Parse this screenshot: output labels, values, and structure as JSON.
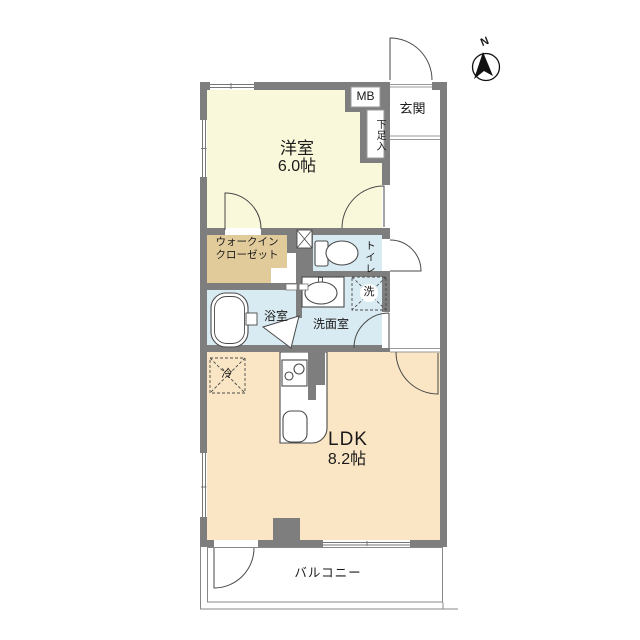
{
  "compass": {
    "north_label": "N"
  },
  "rooms": {
    "bedroom": {
      "name": "洋室",
      "size": "6.0帖"
    },
    "ldk": {
      "name": "LDK",
      "size": "8.2帖"
    },
    "entrance": {
      "name": "玄関"
    },
    "meter_box": {
      "name": "MB"
    },
    "shoe_cabinet": {
      "name": "下足入"
    },
    "walk_in_closet": {
      "line1": "ウォークイン",
      "line2": "クローゼット"
    },
    "toilet": {
      "name": "トイレ"
    },
    "washroom": {
      "name": "洗面室"
    },
    "bathroom": {
      "name": "浴室"
    },
    "washer_space": {
      "name": "洗"
    },
    "refrigerator_space": {
      "name": "冷"
    },
    "balcony": {
      "name": "バルコニー"
    }
  },
  "colors": {
    "wall": "#7e7e7e",
    "bedroom_fill": "#faf8da",
    "ldk_fill": "#fae6c4",
    "closet_fill": "#e2cb9b",
    "wet_area_fill": "#d9ebf2",
    "line": "#4a4a4a"
  }
}
